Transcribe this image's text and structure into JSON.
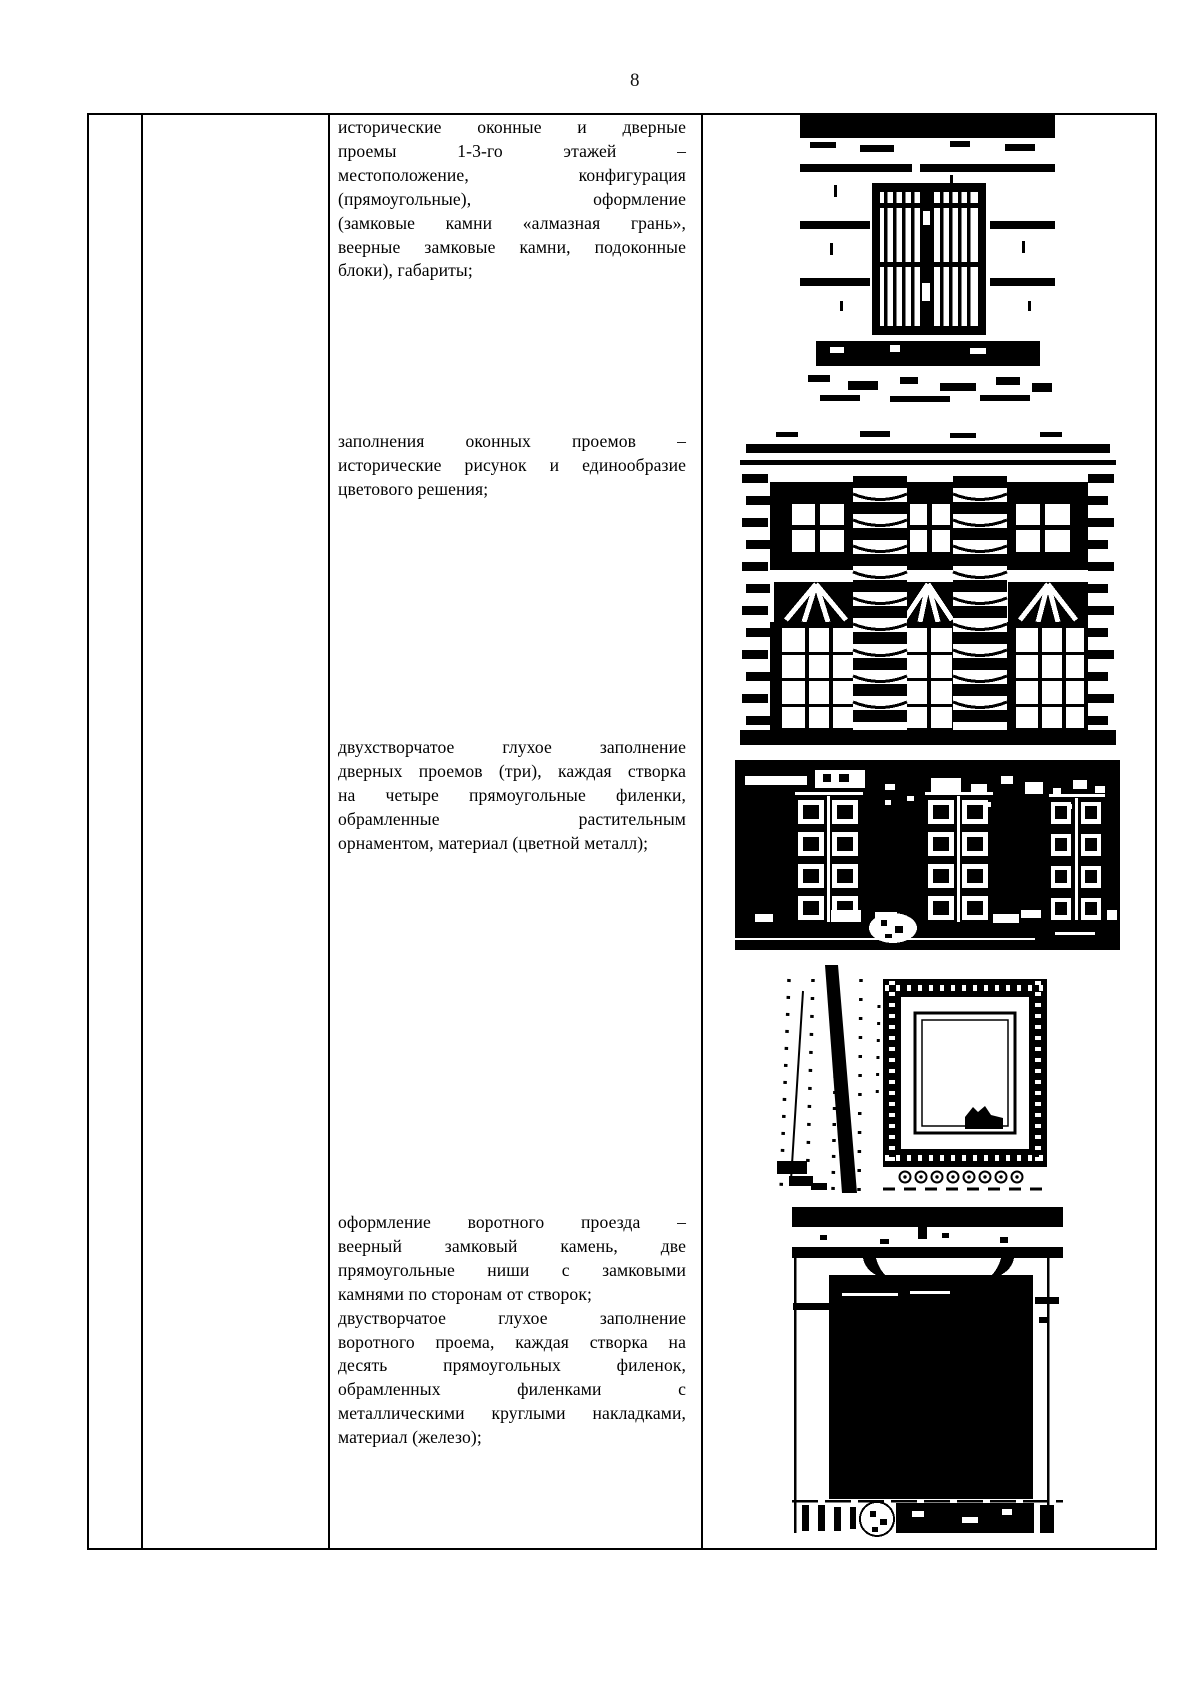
{
  "page": {
    "number": "8"
  },
  "text_column": {
    "blocks": [
      {
        "lines": [
          "исторические оконные и дверные",
          "проемы 1-3-го этажей –",
          "местоположение, конфигурация",
          "(прямоугольные), оформление",
          "(замковые камни «алмазная грань»,",
          "веерные замковые камни, подоконные",
          "блоки), габариты;"
        ]
      },
      {
        "lines": [
          "заполнения оконных проемов –",
          "исторические рисунок и единообразие",
          "цветового решения;"
        ]
      },
      {
        "lines": [
          "двухстворчатое глухое заполнение",
          "дверных проемов (три), каждая створка",
          "на четыре прямоугольные филенки,",
          "обрамленные растительным",
          "орнаментом, материал (цветной металл);"
        ]
      },
      {
        "lines": [
          "оформление воротного проезда –",
          "веерный замковый камень, две",
          "прямоугольные ниши с замковыми",
          "камнями по сторонам от створок;",
          "двустворчатое глухое заполнение",
          "воротного проема, каждая створка на",
          "десять прямоугольных филенок,",
          "обрамленных филенками с",
          "металлическими круглыми накладками,",
          "материал (железо);"
        ]
      }
    ]
  },
  "photo_column": {
    "photos": [
      {
        "description": "окно первого этажа с решеткой на рустованной стене"
      },
      {
        "description": "фрагмент фасада с колоннами и оконными проемами"
      },
      {
        "description": "двухстворчатые дверные заполнения с филенками"
      },
      {
        "description": "окно в орнаментированном наличнике"
      },
      {
        "description": "воротный проезд со створками"
      }
    ]
  }
}
